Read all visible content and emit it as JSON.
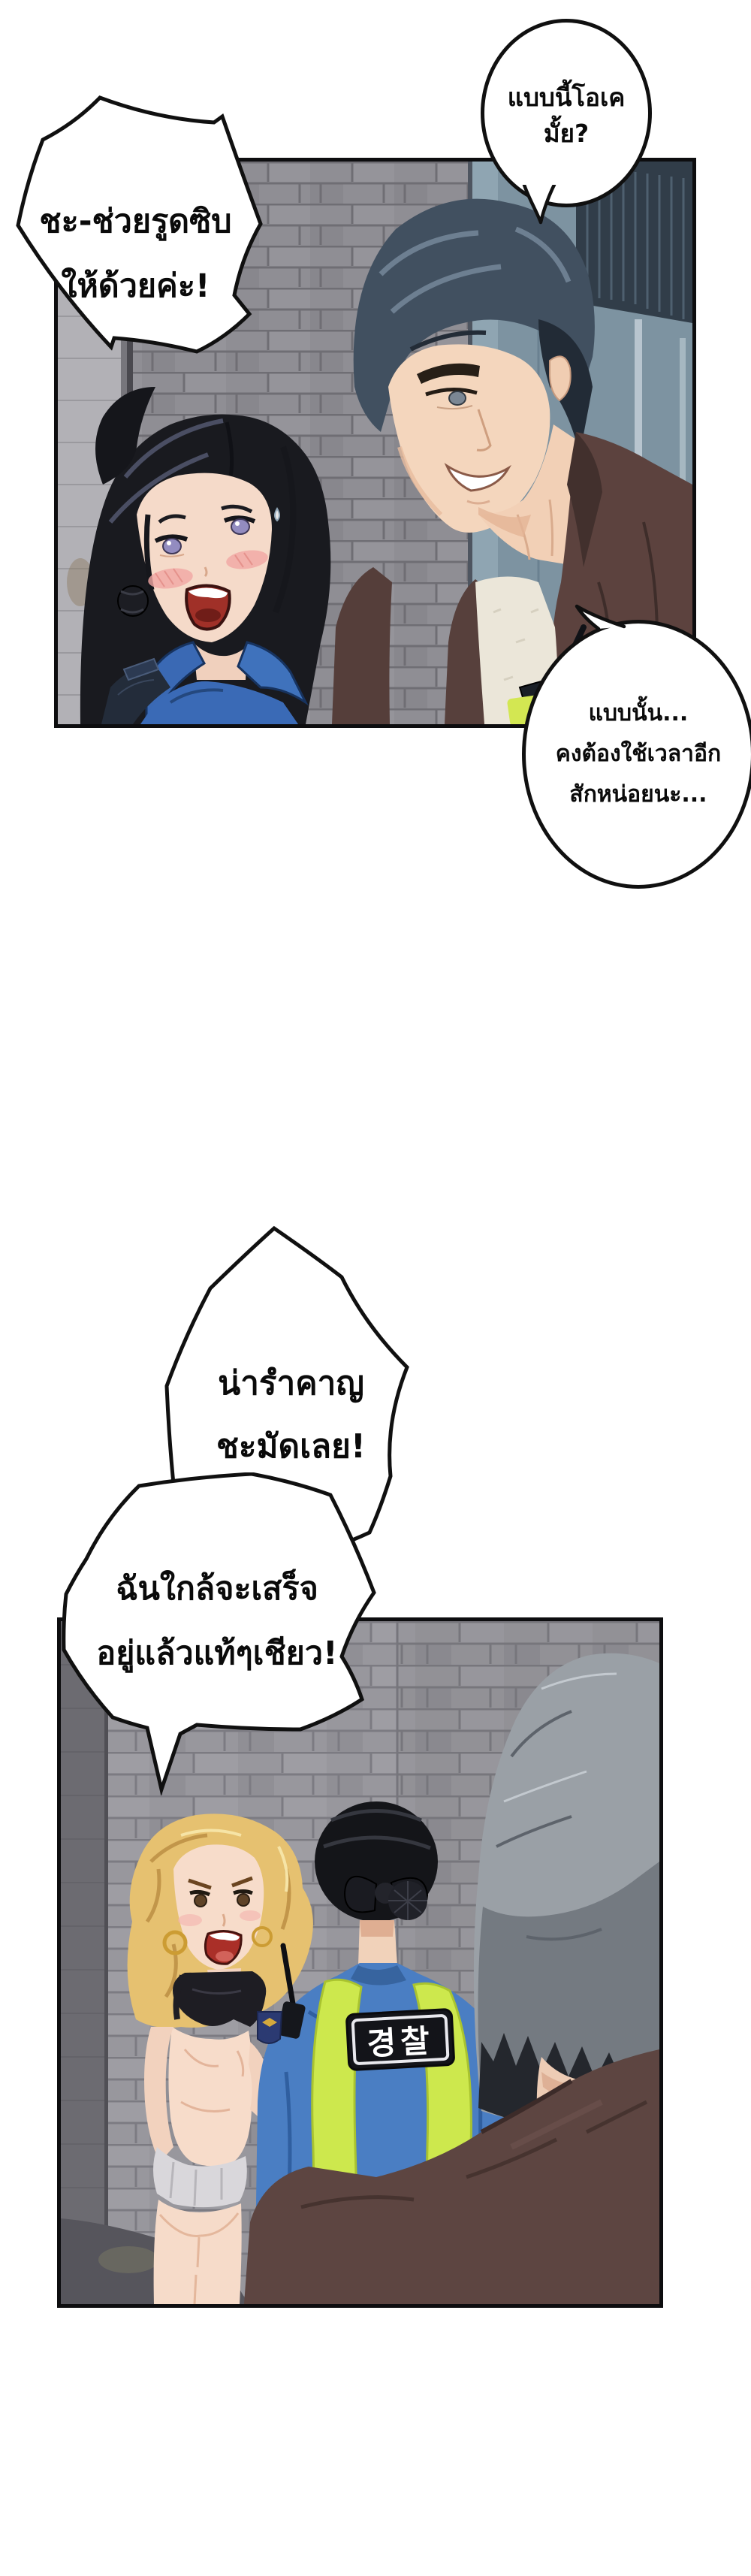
{
  "page": {
    "background": "#ffffff"
  },
  "bubbles": {
    "okay": {
      "lines": [
        "แบบนี้โอเค",
        "มั้ย?"
      ]
    },
    "zip": {
      "lines": [
        "ชะ-ช่วยรูดซิบ",
        "ให้ด้วยค่ะ!"
      ]
    },
    "time": {
      "lines": [
        "แบบนั้น...",
        "คงต้องใช้เวลาอีก",
        "สักหน่อยนะ..."
      ]
    },
    "annoyed": {
      "lines": [
        "น่ารำคาญ",
        "ชะมัดเลย!"
      ]
    },
    "almost": {
      "lines": [
        "ฉันใกล้จะเสร็จ",
        "อยู่แล้วแท้ๆเชียว!"
      ]
    }
  },
  "panel2": {
    "vest_label": "경찰"
  },
  "colors": {
    "panel_border": "#0d0d0f",
    "bubble_outline": "#101010",
    "brick_wall_1": "#8f8e94",
    "brick_wall_2": "#98979d",
    "door_blue_gray": "#7d93a1",
    "police_shirt_blue": "#3a6ab6",
    "officer_shirt_blue": "#4a7ec3",
    "hivis_neon": "#cde84d",
    "vest_navy": "#232c3a",
    "jacket_brown": "#5c423e",
    "man_hair_gray_blue": "#415060",
    "gray_hair": "#9aa0a6",
    "blonde_hair": "#e6c170",
    "skin": "#f5dac9",
    "blush_pink": "#f2a7a4",
    "mouth_red": "#a03028",
    "vest_label_panel": "#131419"
  }
}
